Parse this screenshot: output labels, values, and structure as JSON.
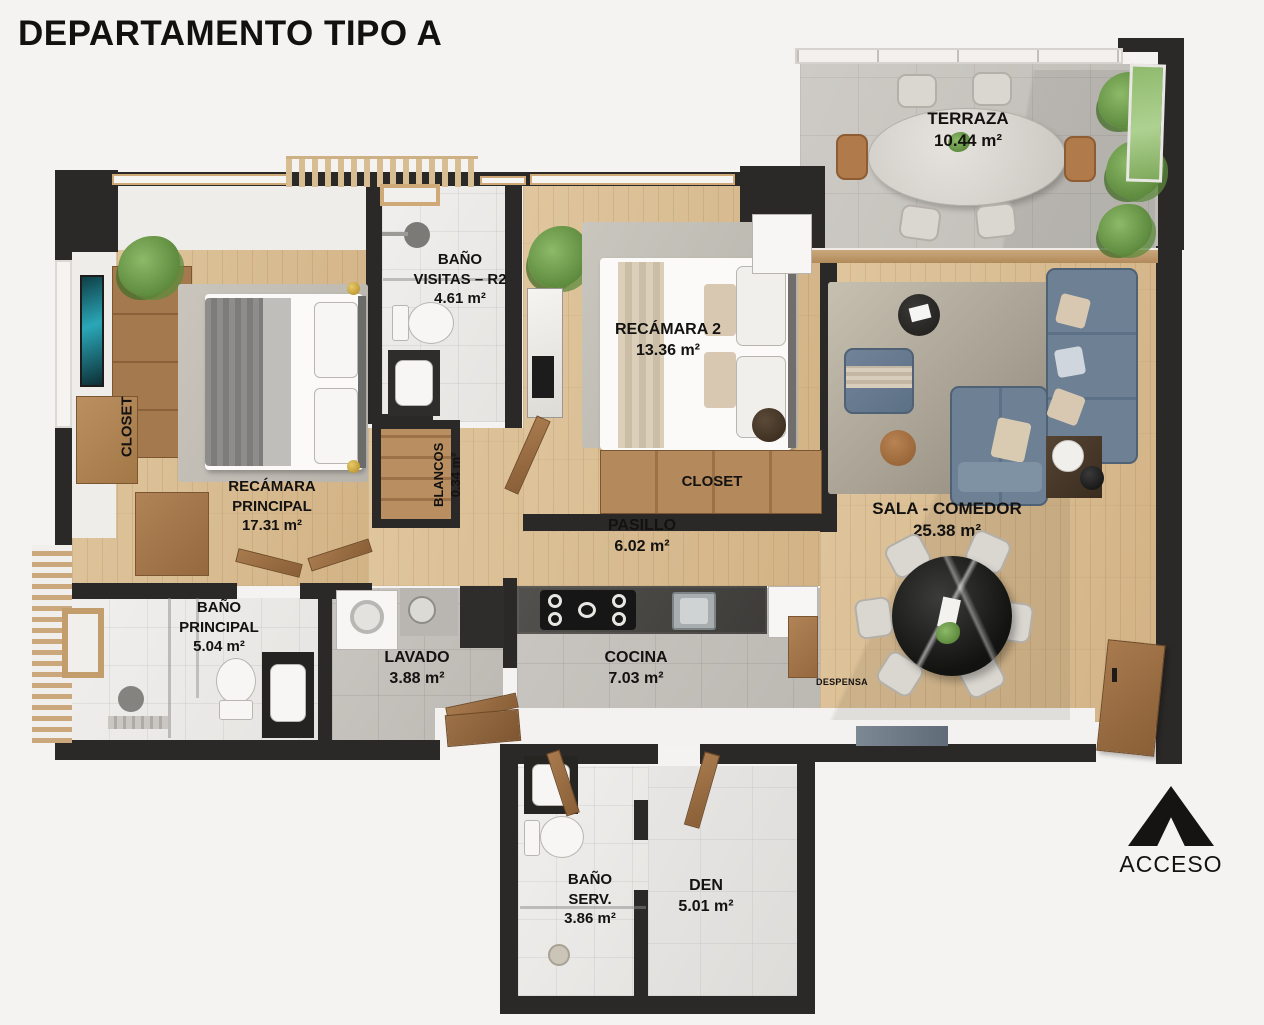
{
  "title": "DEPARTAMENTO TIPO A",
  "acceso_label": "ACCESO",
  "rooms": {
    "terraza": {
      "name": "TERRAZA",
      "area": "10.44 m²"
    },
    "bano_visitas": {
      "name": "BAÑO\nVISITAS – R2",
      "area": "4.61 m²"
    },
    "recamara2": {
      "name": "RECÁMARA 2",
      "area": "13.36 m²"
    },
    "closet_recamara2": {
      "name": "CLOSET"
    },
    "recamara_principal": {
      "name": "RECÁMARA\nPRINCIPAL",
      "area": "17.31 m²"
    },
    "closet_principal": {
      "name": "CLOSET"
    },
    "blancos": {
      "name": "BLANCOS",
      "area": "0.34 m²"
    },
    "pasillo": {
      "name": "PASILLO",
      "area": "6.02 m²"
    },
    "sala_comedor": {
      "name": "SALA - COMEDOR",
      "area": "25.38 m²"
    },
    "bano_principal": {
      "name": "BAÑO\nPRINCIPAL",
      "area": "5.04 m²"
    },
    "lavado": {
      "name": "LAVADO",
      "area": "3.88 m²"
    },
    "cocina": {
      "name": "COCINA",
      "area": "7.03 m²"
    },
    "despensa": {
      "name": "DESPENSA"
    },
    "bano_servicio": {
      "name": "BAÑO\nSERV.",
      "area": "3.86 m²"
    },
    "den": {
      "name": "DEN",
      "area": "5.01 m²"
    }
  },
  "colors": {
    "wall": "#2b2927",
    "wood_floor": "#d8bd94",
    "sofa_blue": "#64788c",
    "plant_green": "#6f9c4e",
    "marble_black": "#1d1d1c"
  }
}
